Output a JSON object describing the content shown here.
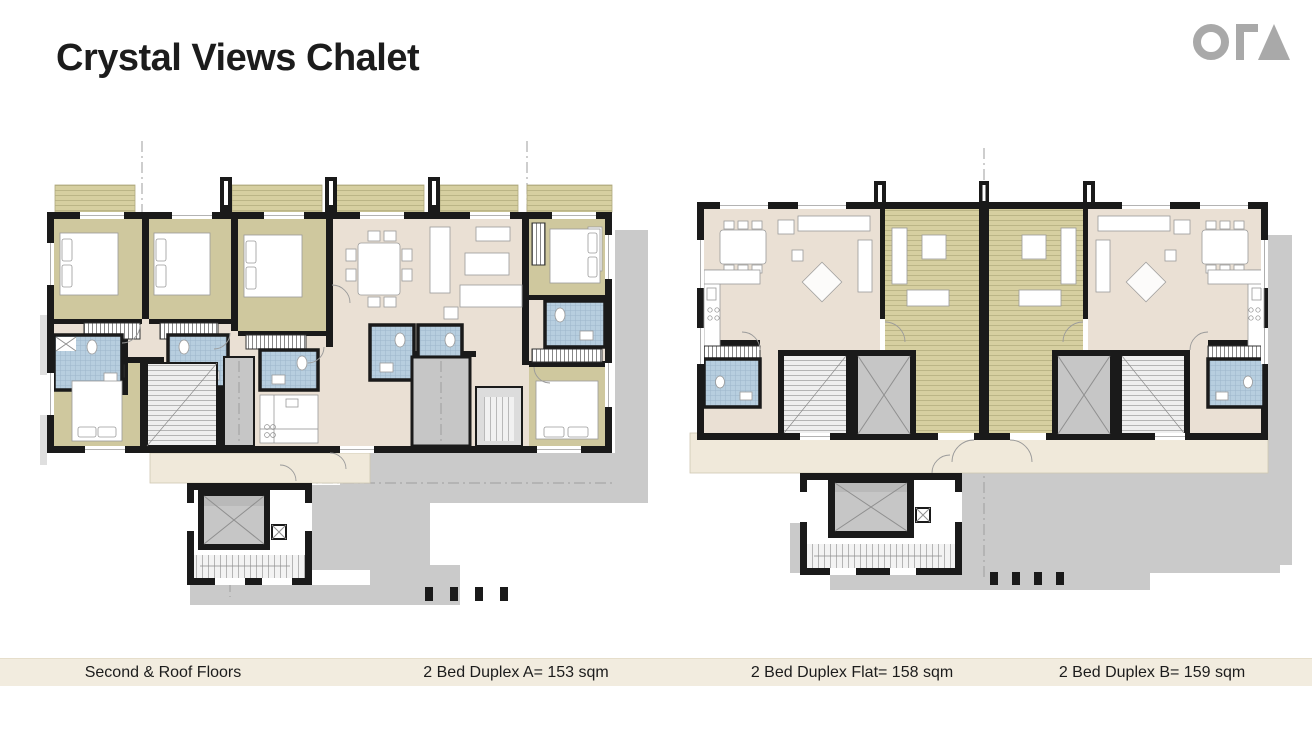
{
  "header": {
    "title": "Crystal Views Chalet",
    "logo_name": "ORA"
  },
  "footer": {
    "labels": [
      "Second & Roof Floors",
      "2 Bed Duplex A= 153 sqm",
      "2 Bed Duplex Flat= 158 sqm",
      "2 Bed Duplex B= 159 sqm"
    ]
  },
  "palette": {
    "page-bg": "#ffffff",
    "ink": "#1c1c1c",
    "logo-gray": "#a9a9a9",
    "bar-bg": "#f2ecdf",
    "wall": "#1a1a1a",
    "olive": "#cfc89e",
    "deck": "#d6cfa0",
    "beige": "#eae0d4",
    "bath": "#b7cedf",
    "terr": "#f0e9da",
    "core": "#c6c6c6",
    "shadow": "#cacaca"
  }
}
